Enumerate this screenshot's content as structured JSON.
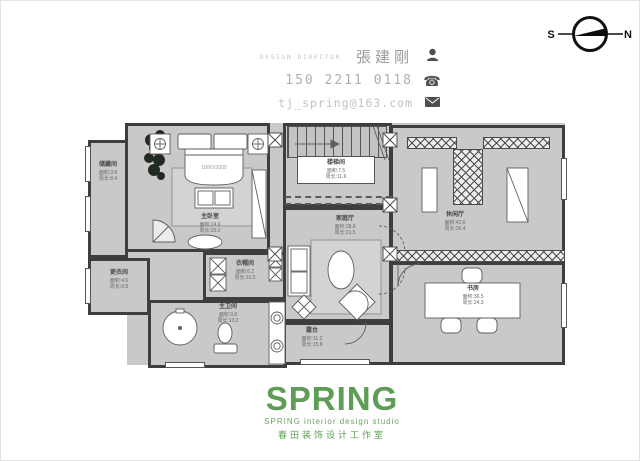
{
  "header": {
    "role_label": "DESIGN DIRECTOR",
    "designer_name": "張建剛",
    "phone": "150 2211 0118",
    "email": "tj_spring@163.com"
  },
  "compass": {
    "south_label": "S",
    "north_label": "N"
  },
  "logo": {
    "brand": "SPRING",
    "subtitle_en": "SPRING interior design studio",
    "subtitle_cn": "春田装饰设计工作室",
    "brand_color": "#5e9d55"
  },
  "plan": {
    "bed_label": "1800X2000",
    "rooms": [
      {
        "name": "储藏间",
        "area": "面积:3.8",
        "perimeter": "周长:8.4"
      },
      {
        "name": "主卧室",
        "area": "面积:24.6",
        "perimeter": "周长:20.2"
      },
      {
        "name": "衣帽间",
        "area": "面积:6.2",
        "perimeter": "周长:10.5"
      },
      {
        "name": "主卫间",
        "area": "面积:9.8",
        "perimeter": "周长:13.2"
      },
      {
        "name": "更衣间",
        "area": "面积:4.6",
        "perimeter": "周长:8.8"
      },
      {
        "name": "楼梯间",
        "area": "面积:7.5",
        "perimeter": "周长:11.6"
      },
      {
        "name": "家庭厅",
        "area": "面积:28.8",
        "perimeter": "周长:21.5"
      },
      {
        "name": "露台",
        "area": "面积:11.2",
        "perimeter": "周长:15.8"
      },
      {
        "name": "休闲厅",
        "area": "面积:42.6",
        "perimeter": "周长:26.4"
      },
      {
        "name": "书房",
        "area": "面积:36.5",
        "perimeter": "周长:24.3"
      }
    ]
  },
  "colors": {
    "wall": "#3e3e3e",
    "floor": "#c9c9c9",
    "hatch": "#4a4a4a"
  }
}
